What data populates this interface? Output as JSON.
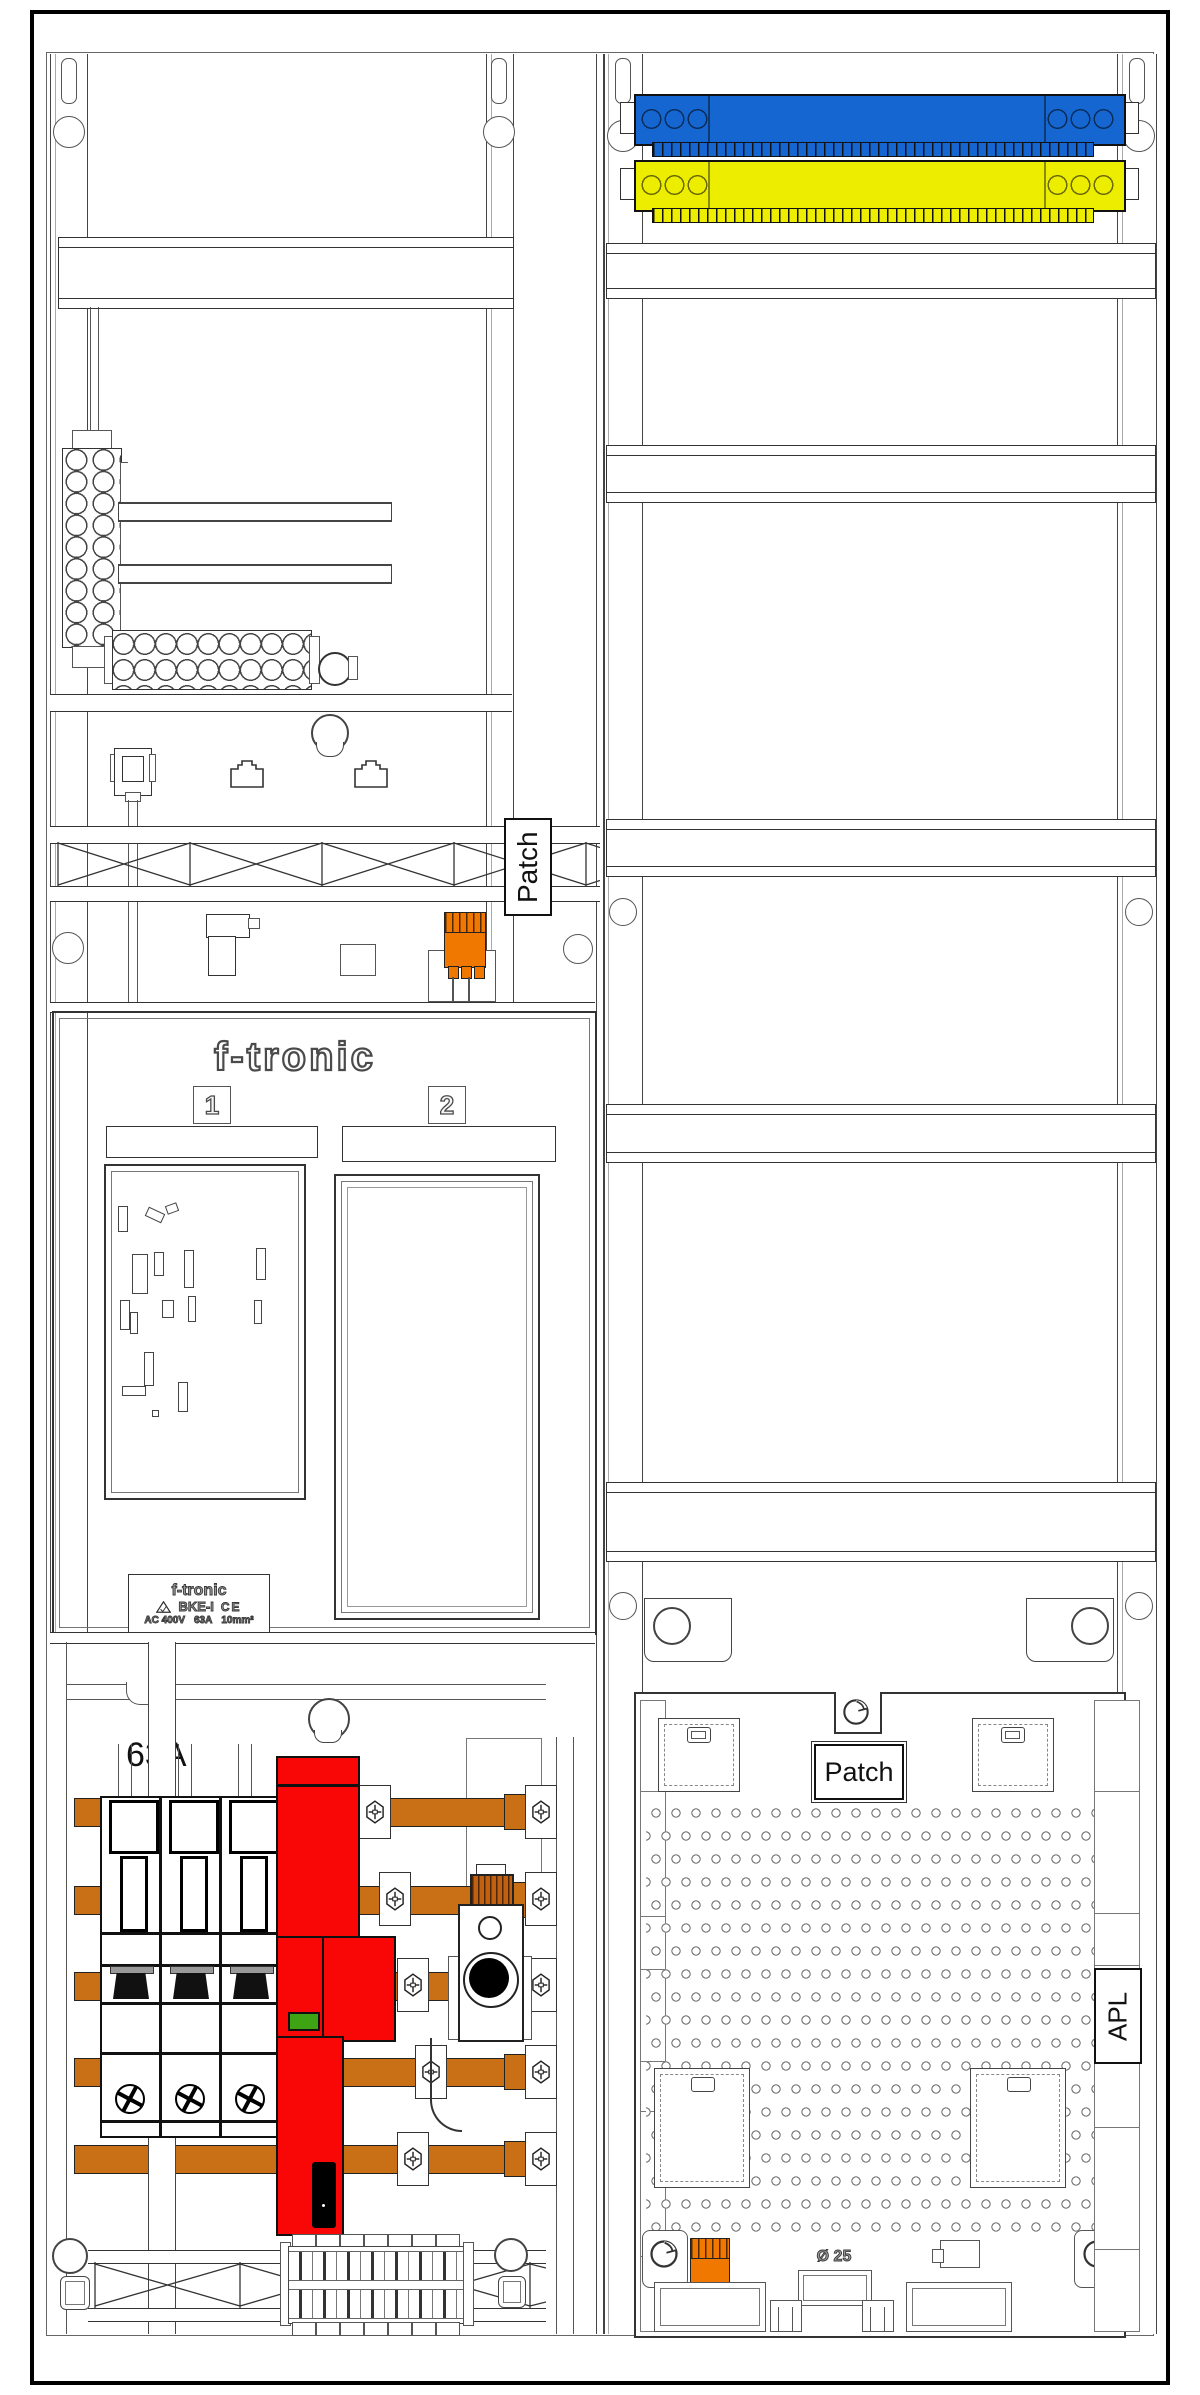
{
  "drawing": {
    "type": "electrical-distribution-cabinet-diagram",
    "labels": {
      "patch_left": "Patch",
      "patch_right": "Patch",
      "apl": "APL",
      "breaker_rating": "63A",
      "knockout_diameter": "Ø 25"
    },
    "brand_logo": "f-tronic",
    "meter_fields": {
      "field1_tag": "1",
      "field2_tag": "2"
    },
    "nameplate": {
      "brand": "f-tronic",
      "model": "BKE-I",
      "ce_mark": "CE",
      "voltage": "AC 400V",
      "current": "63A",
      "cross_section": "10mm²"
    },
    "colors": {
      "neutral_busbar_blue": "#1566D0",
      "pe_busbar_yellow": "#EDED00",
      "copper_busbar_orange": "#C96F15",
      "connector_orange": "#F07800",
      "main_switch_red": "#F90606",
      "indicator_green": "#3EA414"
    },
    "icons": {
      "lock-icon": "circle-with-notch",
      "hex-screw-icon": "hexagon-phillips-screw",
      "terminal-screw-icon": "phillips-screw-circle",
      "cert-triangle-icon": "approval-triangle",
      "rj45-icon": "rj45-jack-outline"
    }
  }
}
